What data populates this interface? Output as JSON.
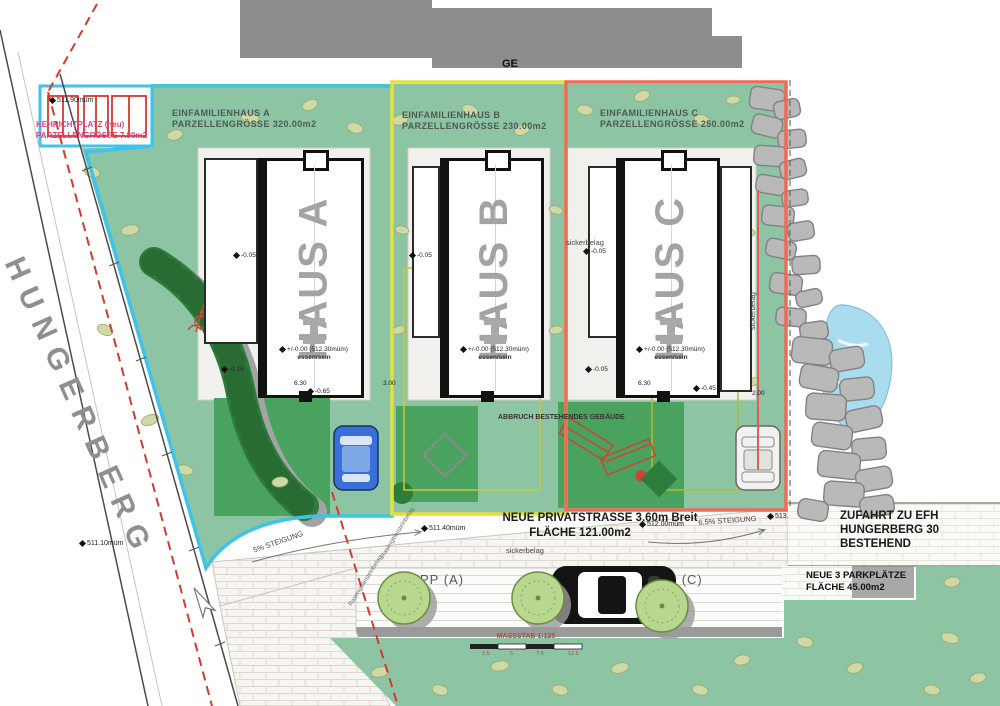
{
  "street": {
    "name": "HUNGERBERG"
  },
  "north_building": {
    "label": "GE"
  },
  "kehrichtplatz": {
    "line1": "KEHRICHTPLATZ (neu)",
    "line2": "PARZELLENGRÖSSE 7.80m2"
  },
  "parcels": [
    {
      "name": "EINFAMILIENHAUS A",
      "size": "PARZELLENGRÖSSE 320.00m2",
      "house": "HAUS A",
      "level": "+/-0.00 (512.30müm)",
      "room": "essen/sein",
      "color": "#3fc3e8"
    },
    {
      "name": "EINFAMILIENHAUS B",
      "size": "PARZELLENGRÖSSE 230.00m2",
      "house": "HAUS B",
      "level": "+/-0.00 (512.30müm)",
      "room": "essen/sein",
      "color": "#e3df3e"
    },
    {
      "name": "EINFAMILIENHAUS C",
      "size": "PARZELLENGRÖSSE 250.00m2",
      "house": "HAUS C",
      "level": "+/-0.00 (512.30müm)",
      "room": "essen/sein",
      "color": "#ef6a57"
    }
  ],
  "surfaces": {
    "sickerbelag": "sickerbelag",
    "pavement_note": "Rasengittersteinbelag"
  },
  "road": {
    "line1": "NEUE PRIVATSTRASSE 3.60m Breit",
    "line2": "FLÄCHE 121.00m2",
    "slope_left": "5% STEIGUNG",
    "slope_right": "6.5% STEIGUNG"
  },
  "driveway": {
    "line1": "ZUFAHRT ZU EFH",
    "line2": "HUNGERBERG 30",
    "line3": "BESTEHEND"
  },
  "parking": {
    "stall_a": "PP (A)",
    "stall_b": "PP (B)",
    "stall_c": "PP (C)",
    "note1": "NEUE 3 PARKPLÄTZE",
    "note2": "FLÄCHE 45.00m2"
  },
  "demolition": {
    "note": "ABBRUCH BESTEHENDES GEBÄUDE"
  },
  "scalebar": {
    "label": "MASSSTAB 1:125",
    "t1": "2.5",
    "t2": "5",
    "t3": "7.5",
    "t4": "12.5"
  },
  "levels": {
    "l1": "511.10müm",
    "l2": "511.40müm",
    "l3": "512.00müm",
    "l4": "513.",
    "l5": "511.90müm"
  },
  "dims": {
    "d1": "-0.05",
    "d2": "-0.05",
    "d3": "-0.05",
    "d4": "-0.15",
    "d5": "6.30",
    "d6": "-0.65",
    "d7": "3.00",
    "d8": "6.30",
    "d9": "-0.45",
    "d10": "-0.05",
    "d11": "2.00"
  }
}
